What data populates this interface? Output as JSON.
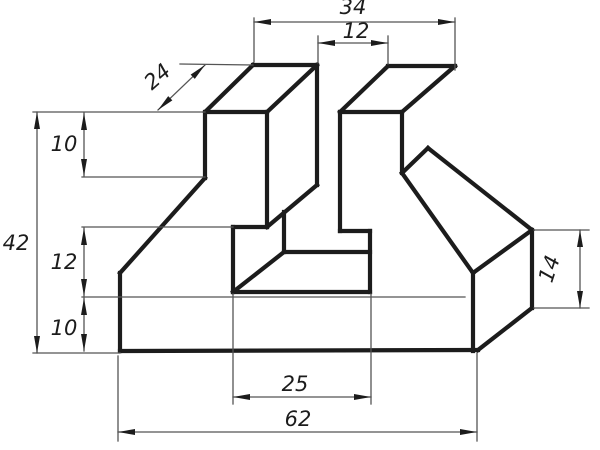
{
  "drawing": {
    "type": "technical-orthographic-pictorial",
    "background": "#ffffff",
    "edge_color": "#1c1c1c",
    "thin_color": "#555555",
    "dimension_values": [
      "34",
      "12",
      "24",
      "10",
      "42",
      "12",
      "10",
      "25",
      "62",
      "14"
    ],
    "part_edges": [
      [
        205,
        112,
        205,
        178
      ],
      [
        205,
        112,
        253,
        65
      ],
      [
        253,
        65,
        317,
        65
      ],
      [
        267,
        112,
        317,
        65
      ],
      [
        206,
        112,
        267,
        112
      ],
      [
        317,
        65,
        317,
        185
      ],
      [
        267,
        112,
        267,
        227
      ],
      [
        317,
        185,
        267,
        227
      ],
      [
        205,
        178,
        120,
        273
      ],
      [
        120,
        273,
        120,
        351
      ],
      [
        120,
        351,
        478,
        350
      ],
      [
        233,
        227,
        267,
        227
      ],
      [
        233,
        227,
        233,
        292
      ],
      [
        233,
        292,
        370,
        292
      ],
      [
        284,
        212,
        284,
        252
      ],
      [
        284,
        252,
        370,
        252
      ],
      [
        284,
        252,
        233,
        292
      ],
      [
        370,
        292,
        370,
        231
      ],
      [
        340,
        231,
        370,
        231
      ],
      [
        340,
        112,
        340,
        231
      ],
      [
        340,
        112,
        402,
        112
      ],
      [
        340,
        112,
        388,
        66
      ],
      [
        388,
        66,
        455,
        66
      ],
      [
        402,
        112,
        455,
        66
      ],
      [
        402,
        112,
        402,
        173
      ],
      [
        402,
        173,
        428,
        148
      ],
      [
        428,
        148,
        532,
        230
      ],
      [
        402,
        173,
        473,
        273
      ],
      [
        473,
        273,
        532,
        230
      ],
      [
        532,
        230,
        532,
        308
      ],
      [
        532,
        308,
        478,
        350
      ],
      [
        473,
        273,
        473,
        351
      ]
    ],
    "extension_lines": [
      [
        33,
        112,
        205,
        112
      ],
      [
        82,
        177,
        205,
        177
      ],
      [
        82,
        227,
        233,
        227
      ],
      [
        82,
        297,
        465,
        297
      ],
      [
        33,
        353,
        120,
        353
      ],
      [
        180,
        64,
        253,
        65
      ],
      [
        254,
        18,
        254,
        62
      ],
      [
        455,
        18,
        455,
        70
      ],
      [
        318,
        36,
        318,
        63
      ],
      [
        388,
        36,
        388,
        64
      ],
      [
        534,
        230,
        589,
        230
      ],
      [
        534,
        308,
        589,
        308
      ],
      [
        233,
        294,
        233,
        404
      ],
      [
        371,
        294,
        371,
        404
      ],
      [
        118,
        356,
        118,
        441
      ],
      [
        477,
        353,
        477,
        441
      ]
    ],
    "dimensions": [
      {
        "name": "overall-top-width",
        "label": "34",
        "from": [
          254,
          22
        ],
        "to": [
          455,
          22
        ],
        "text_at": [
          353,
          14
        ],
        "rotation": 0
      },
      {
        "name": "slot-width",
        "label": "12",
        "from": [
          318,
          43
        ],
        "to": [
          388,
          43
        ],
        "text_at": [
          356,
          38
        ],
        "rotation": 0
      },
      {
        "name": "flange-depth",
        "label": "24",
        "from": [
          158,
          110
        ],
        "to": [
          205,
          65
        ],
        "text_at": [
          162,
          82
        ],
        "rotation": -41
      },
      {
        "name": "flange-thickness",
        "label": "10",
        "from": [
          84,
          113
        ],
        "to": [
          84,
          176
        ],
        "text_at": [
          64,
          151
        ],
        "rotation": 0
      },
      {
        "name": "overall-height",
        "label": "42",
        "from": [
          37,
          112
        ],
        "to": [
          37,
          353
        ],
        "text_at": [
          16,
          250
        ],
        "rotation": 0
      },
      {
        "name": "mid-step-height",
        "label": "12",
        "from": [
          84,
          228
        ],
        "to": [
          84,
          296
        ],
        "text_at": [
          64,
          269
        ],
        "rotation": 0
      },
      {
        "name": "base-thickness",
        "label": "10",
        "from": [
          84,
          298
        ],
        "to": [
          84,
          351
        ],
        "text_at": [
          64,
          335
        ],
        "rotation": 0
      },
      {
        "name": "right-face-height",
        "label": "14",
        "from": [
          580,
          230
        ],
        "to": [
          580,
          308
        ],
        "text_at": [
          556,
          271
        ],
        "rotation": -72
      },
      {
        "name": "slot-opening-width",
        "label": "25",
        "from": [
          233,
          397
        ],
        "to": [
          371,
          397
        ],
        "text_at": [
          295,
          391
        ],
        "rotation": 0
      },
      {
        "name": "overall-length",
        "label": "62",
        "from": [
          118,
          432
        ],
        "to": [
          477,
          432
        ],
        "text_at": [
          298,
          426
        ],
        "rotation": 0
      }
    ]
  }
}
